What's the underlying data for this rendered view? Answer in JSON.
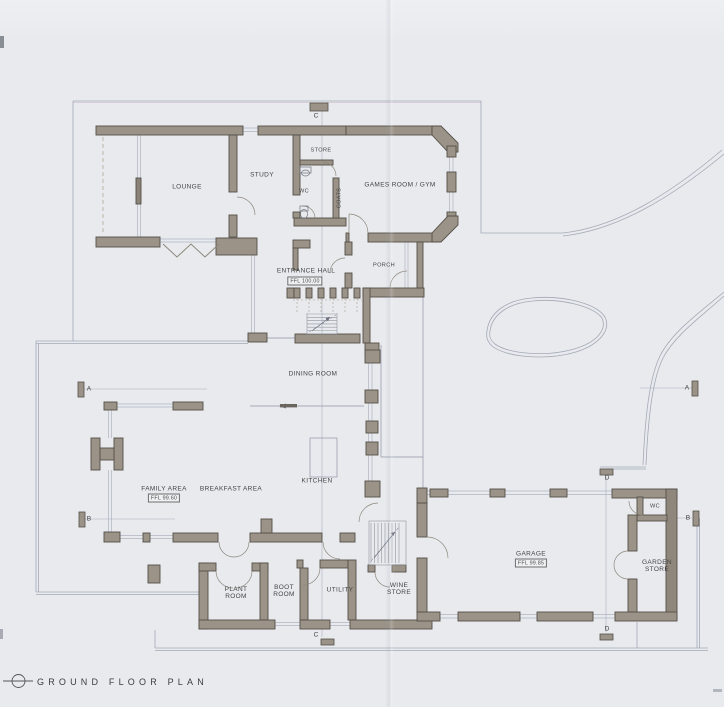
{
  "title": {
    "label": "GROUND FLOOR PLAN"
  },
  "rooms": {
    "lounge": {
      "label": "LOUNGE"
    },
    "study": {
      "label": "STUDY"
    },
    "store": {
      "label": "STORE"
    },
    "wc_north": {
      "label": "WC"
    },
    "coats": {
      "label": "COATS"
    },
    "games_room": {
      "label": "GAMES ROOM / GYM"
    },
    "entrance_hall": {
      "label": "ENTRANCE HALL",
      "ffl": "FFL 100.00"
    },
    "porch": {
      "label": "PORCH"
    },
    "dining_room": {
      "label": "DINING ROOM"
    },
    "family_area": {
      "label": "FAMILY AREA",
      "ffl": "FFL 99.60"
    },
    "breakfast_area": {
      "label": "BREAKFAST AREA"
    },
    "kitchen": {
      "label": "KITCHEN"
    },
    "plant_room": {
      "label": "PLANT ROOM"
    },
    "boot_room": {
      "label": "BOOT ROOM"
    },
    "utility": {
      "label": "UTILITY"
    },
    "wine_store": {
      "label": "WINE STORE"
    },
    "garage": {
      "label": "GARAGE",
      "ffl": "FFL 99.85"
    },
    "wc_garage": {
      "label": "WC"
    },
    "garden_store": {
      "label": "GARDEN STORE"
    }
  },
  "section_markers": {
    "a_left": "A",
    "a_right": "A",
    "b_left": "B",
    "b_right": "B",
    "c_top": "C",
    "c_bottom": "C",
    "d_top": "D",
    "d_bottom": "D"
  },
  "colors": {
    "paper": "#e8eaee",
    "wall_fill": "#9b9387",
    "wall_outline": "#544f48",
    "thin_line": "#a3a9b6",
    "glazing": "#aeb5c2",
    "text": "#454545"
  }
}
